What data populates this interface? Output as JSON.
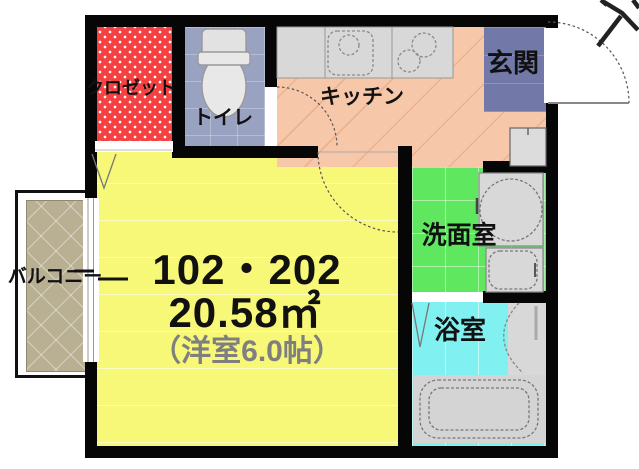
{
  "unit": {
    "numbers": "102・202",
    "area": "20.58㎡",
    "note": "（洋室6.0帖）"
  },
  "rooms": {
    "closet": {
      "label": "クロゼット"
    },
    "toilet": {
      "label": "トイレ"
    },
    "kitchen": {
      "label": "キッチン"
    },
    "entrance": {
      "label": "玄関"
    },
    "washroom": {
      "label": "洗面室"
    },
    "bathroom": {
      "label": "浴室"
    },
    "balcony": {
      "label": "バルコニー"
    }
  },
  "fixtures": {
    "icons": [
      "toilet-fixture-icon",
      "kitchen-sink-icon",
      "stove-burners-icon",
      "shoe-cabinet-icon",
      "washing-machine-icon",
      "washbasin-icon",
      "bathtub-icon",
      "entrance-door-swing-icon",
      "room-door-swing-icon",
      "toilet-door-swing-icon",
      "folding-door-icon",
      "sliding-window-icon",
      "north-arrow-icon"
    ]
  },
  "colors": {
    "wall": "#060606",
    "main_room_floor": "#f7f778",
    "closet_floor": "#f54141",
    "toilet_floor": "#9aa2c2",
    "kitchen_floor": "#f7c7a9",
    "entrance_floor": "#7279a8",
    "washroom_floor": "#5fe75f",
    "bathroom_floor": "#80f0f0",
    "balcony_deck": "#b9b094",
    "fixture_gray": "#d8d8d8",
    "note_text": "#7f7f7f"
  }
}
